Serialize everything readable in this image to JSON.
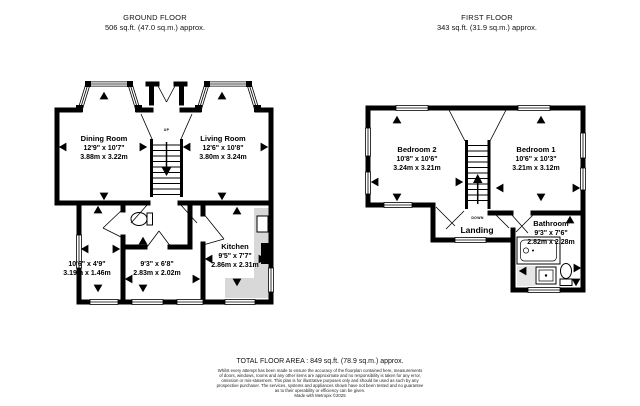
{
  "ground": {
    "title": "GROUND FLOOR",
    "area": "506 sq.ft. (47.0 sq.m.) approx.",
    "rooms": {
      "dining": {
        "name": "Dining Room",
        "imperial": "12'9\" x 10'7\"",
        "metric": "3.88m x 3.22m"
      },
      "living": {
        "name": "Living Room",
        "imperial": "12'6\" x 10'8\"",
        "metric": "3.80m x 3.24m"
      },
      "kitchen": {
        "name": "Kitchen",
        "imperial": "9'5\" x 7'7\"",
        "metric": "2.86m x 2.31m"
      },
      "hall": {
        "imperial": "9'3\" x 6'8\"",
        "metric": "2.83m x 2.02m"
      },
      "side": {
        "imperial": "10'6\" x 4'9\"",
        "metric": "3.19m x 1.46m"
      },
      "stairs_label": "UP"
    }
  },
  "first": {
    "title": "FIRST FLOOR",
    "area": "343 sq.ft. (31.9 sq.m.) approx.",
    "rooms": {
      "bedroom2": {
        "name": "Bedroom 2",
        "imperial": "10'8\" x 10'6\"",
        "metric": "3.24m x 3.21m"
      },
      "bedroom1": {
        "name": "Bedroom 1",
        "imperial": "10'6\" x 10'3\"",
        "metric": "3.21m x 3.12m"
      },
      "landing": {
        "name": "Landing"
      },
      "bathroom": {
        "name": "Bathroom",
        "imperial": "9'3\" x 7'6\"",
        "metric": "2.82m x 2.28m"
      },
      "stairs_label": "DOWN"
    }
  },
  "footer": {
    "total": "TOTAL FLOOR AREA : 849 sq.ft. (78.9 sq.m.) approx.",
    "disclaimer": {
      "line1": "Whilst every attempt has been made to ensure the accuracy of the floorplan contained here, measurements",
      "line2": "of doors, windows, rooms and any other items are approximate and no responsibility is taken for any error,",
      "line3": "omission or mis-statement. This plan is for illustrative purposes only and should be used as such by any",
      "line4": "prospective purchaser. The services, systems and appliances shown have not been tested and no guarantee",
      "line5": "as to their operability or efficiency can be given.",
      "credit": "Made with Metropix ©2025"
    }
  },
  "colors": {
    "wall": "#000000",
    "counter": "#d8d8d8"
  }
}
